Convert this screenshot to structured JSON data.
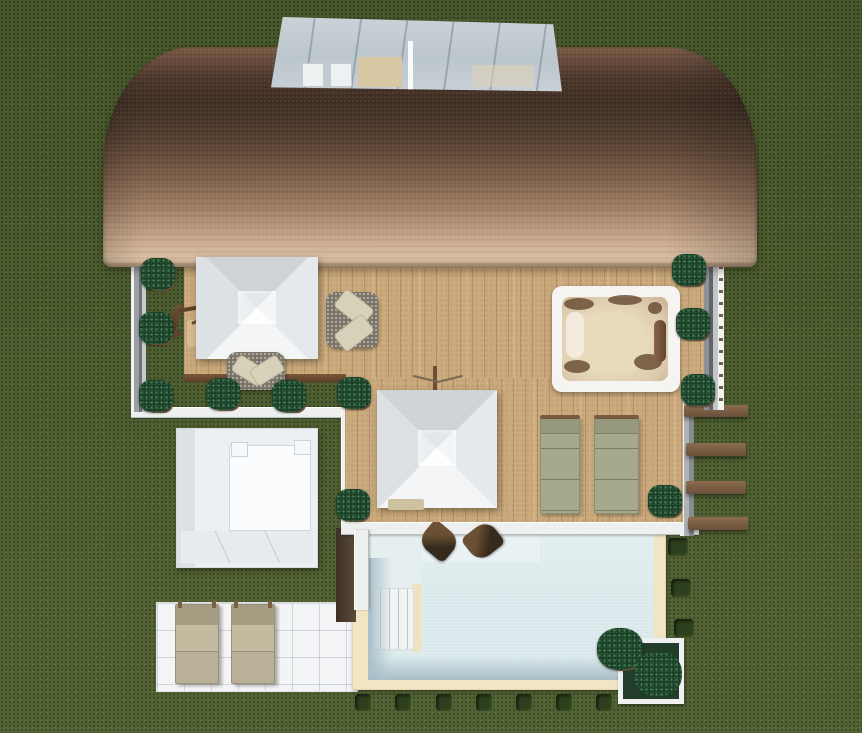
{
  "scene": {
    "type": "3d-architectural-render",
    "view": "aerial-top-down",
    "description": "Top-down rendering of a villa with a barrel-vaulted shingle roof and glass skylight, a wooden roof terrace with two white pyramid cantilever umbrellas, corner sofas, a hot tub, glass railings, a pergola stair, a white garden daybed pavilion, a swimming pool with tanning shelf, steps and two in-pool loungers, a white tiled patio with two sun loungers, boxwood planters and trimmed hedge blocks on a lawn."
  },
  "palette": {
    "grass": "#4b5b2e",
    "roof_dark": "#3f2d23",
    "roof_light": "#d9bda1",
    "deck_wood": "#cbaa7d",
    "canopy_gray": "#dde1e3",
    "pool_water": "#d6e7e9",
    "pool_shadow": "#a9bec8",
    "pool_coping": "#f1e5c4",
    "patio_tile": "#f3f4f6",
    "bush_green": "#17351f",
    "hedge_green": "#2d401e",
    "pergola_wood": "#7c5e44",
    "hot_tub_shell": "#f6f4f0",
    "hot_tub_basin": "#dcc9ab",
    "lounger_sage": "#a6a98b",
    "lounger_beige": "#b9b097",
    "railing_gray": "#9aa0a3",
    "wall_white": "#eef0f0",
    "skylight_glass": "#c6cfd5"
  },
  "elements": [
    "grass-lawn",
    "barrel-roof",
    "roof-skylight",
    "upper-wood-deck",
    "lower-wood-deck",
    "cantilever-umbrella-upper",
    "cantilever-umbrella-lower",
    "corner-sofa-upper",
    "corner-sofa-lower",
    "hot-tub",
    "glass-railing-left",
    "glass-railing-right",
    "pergola-stairs",
    "garden-daybed-pavilion",
    "swimming-pool",
    "pool-tanning-shelf",
    "pool-steps",
    "in-pool-loungers",
    "deck-sun-loungers",
    "tiled-patio",
    "patio-sun-loungers",
    "boxwood-planters",
    "hedge-blocks",
    "corner-tree-planter"
  ]
}
